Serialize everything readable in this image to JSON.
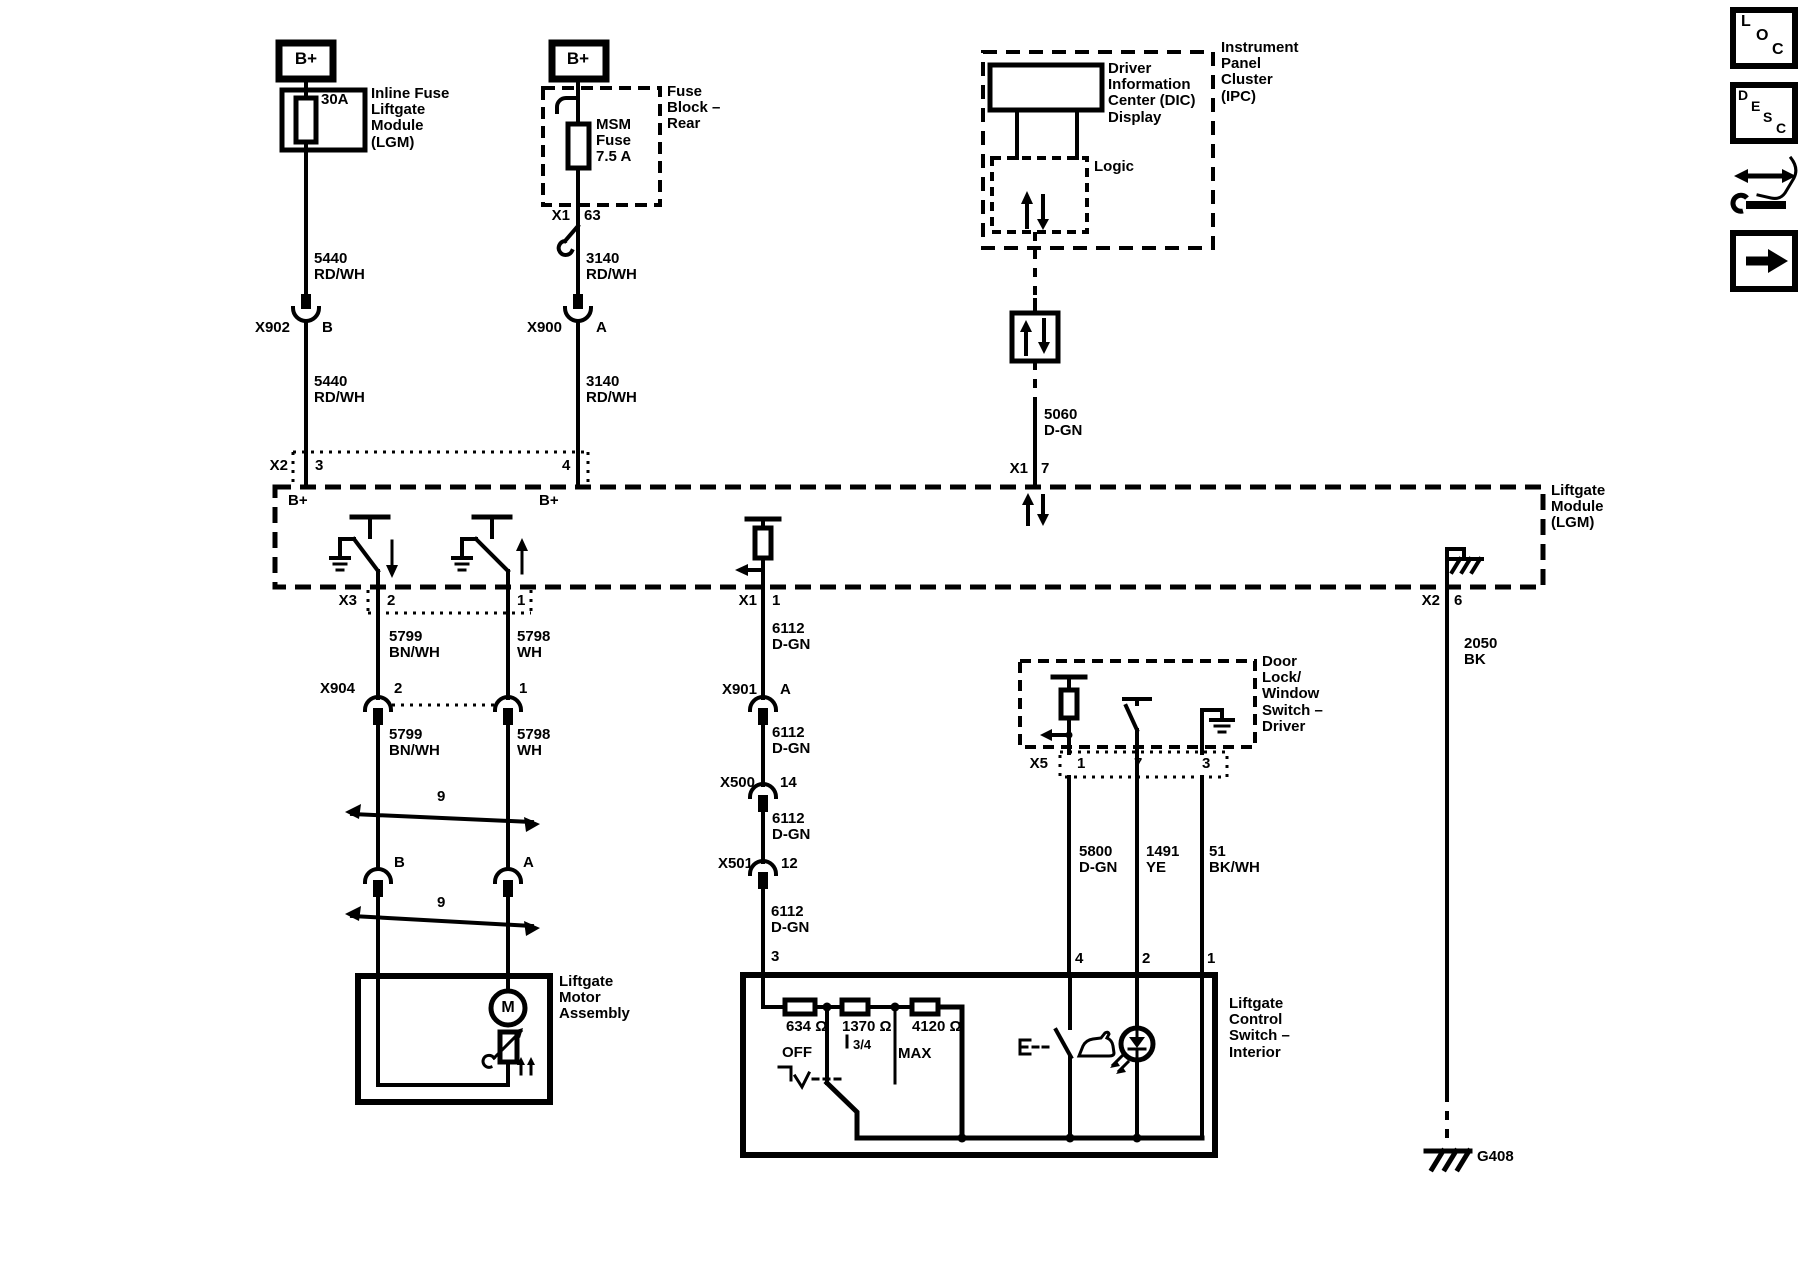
{
  "canvas": {
    "background": "#ffffff",
    "ink": "#000000",
    "kind": "wiring-diagram"
  },
  "labels": [
    {
      "name": "bplus-left-label",
      "x": 306,
      "y": 50,
      "text": "B+",
      "align": "center",
      "size": 17
    },
    {
      "name": "fuse-30a-rating",
      "x": 321,
      "y": 92,
      "text": "30A"
    },
    {
      "name": "inline-fuse-caption",
      "x": 371,
      "y": 86,
      "text": "Inline Fuse\nLiftgate\nModule\n(LGM)"
    },
    {
      "name": "wire-5440-upper",
      "x": 314,
      "y": 251,
      "text": "5440\nRD/WH"
    },
    {
      "name": "conn-x902",
      "x": 290,
      "y": 320,
      "text": "X902",
      "align": "right"
    },
    {
      "name": "conn-x902-pin-b",
      "x": 322,
      "y": 320,
      "text": "B"
    },
    {
      "name": "wire-5440-lower",
      "x": 314,
      "y": 374,
      "text": "5440\nRD/WH"
    },
    {
      "name": "conn-x2-label",
      "x": 288,
      "y": 458,
      "text": "X2",
      "align": "right"
    },
    {
      "name": "conn-x2-pin-3",
      "x": 315,
      "y": 458,
      "text": "3"
    },
    {
      "name": "conn-x2-pin-4",
      "x": 562,
      "y": 458,
      "text": "4"
    },
    {
      "name": "bplus-right-label",
      "x": 578,
      "y": 50,
      "text": "B+",
      "align": "center",
      "size": 17
    },
    {
      "name": "fuse-block-caption",
      "x": 667,
      "y": 84,
      "text": "Fuse\nBlock –\nRear"
    },
    {
      "name": "msm-fuse-caption",
      "x": 596,
      "y": 117,
      "text": "MSM\nFuse\n7.5 A"
    },
    {
      "name": "conn-x1-63",
      "x": 570,
      "y": 208,
      "text": "X1",
      "align": "right"
    },
    {
      "name": "conn-x1-pin-63",
      "x": 584,
      "y": 208,
      "text": "63"
    },
    {
      "name": "wire-3140-upper",
      "x": 586,
      "y": 251,
      "text": "3140\nRD/WH"
    },
    {
      "name": "conn-x900",
      "x": 562,
      "y": 320,
      "text": "X900",
      "align": "right"
    },
    {
      "name": "conn-x900-pin-a",
      "x": 596,
      "y": 320,
      "text": "A"
    },
    {
      "name": "wire-3140-lower",
      "x": 586,
      "y": 374,
      "text": "3140\nRD/WH"
    },
    {
      "name": "lgm-bplus-left",
      "x": 288,
      "y": 493,
      "text": "B+"
    },
    {
      "name": "lgm-bplus-right",
      "x": 539,
      "y": 493,
      "text": "B+"
    },
    {
      "name": "lgm-caption",
      "x": 1551,
      "y": 483,
      "text": "Liftgate\nModule\n(LGM)"
    },
    {
      "name": "conn-x3",
      "x": 357,
      "y": 593,
      "text": "X3",
      "align": "right"
    },
    {
      "name": "conn-x3-pin-2",
      "x": 387,
      "y": 593,
      "text": "2"
    },
    {
      "name": "conn-x3-pin-1",
      "x": 517,
      "y": 593,
      "text": "1"
    },
    {
      "name": "conn-x1-1",
      "x": 757,
      "y": 593,
      "text": "X1",
      "align": "right"
    },
    {
      "name": "conn-x1-pin-1",
      "x": 772,
      "y": 593,
      "text": "1"
    },
    {
      "name": "conn-x1-7",
      "x": 1028,
      "y": 461,
      "text": "X1",
      "align": "right"
    },
    {
      "name": "conn-x1-pin-7",
      "x": 1041,
      "y": 461,
      "text": "7"
    },
    {
      "name": "conn-x2-6",
      "x": 1440,
      "y": 593,
      "text": "X2",
      "align": "right"
    },
    {
      "name": "conn-x2-pin-6",
      "x": 1454,
      "y": 593,
      "text": "6"
    },
    {
      "name": "wire-5799-upper",
      "x": 389,
      "y": 629,
      "text": "5799\nBN/WH"
    },
    {
      "name": "wire-5798-upper",
      "x": 517,
      "y": 629,
      "text": "5798\nWH"
    },
    {
      "name": "conn-x904",
      "x": 355,
      "y": 681,
      "text": "X904",
      "align": "right"
    },
    {
      "name": "conn-x904-pin-2",
      "x": 394,
      "y": 681,
      "text": "2"
    },
    {
      "name": "conn-x904-pin-1",
      "x": 519,
      "y": 681,
      "text": "1"
    },
    {
      "name": "wire-5799-lower",
      "x": 389,
      "y": 727,
      "text": "5799\nBN/WH"
    },
    {
      "name": "wire-5798-lower",
      "x": 517,
      "y": 727,
      "text": "5798\nWH"
    },
    {
      "name": "twisted-pair-9-upper",
      "x": 437,
      "y": 789,
      "text": "9"
    },
    {
      "name": "conn-b",
      "x": 394,
      "y": 855,
      "text": "B"
    },
    {
      "name": "conn-a",
      "x": 523,
      "y": 855,
      "text": "A"
    },
    {
      "name": "twisted-pair-9-lower",
      "x": 437,
      "y": 895,
      "text": "9"
    },
    {
      "name": "motor-caption",
      "x": 559,
      "y": 974,
      "text": "Liftgate\nMotor\nAssembly"
    },
    {
      "name": "motor-m",
      "x": 508,
      "y": 999,
      "text": "M",
      "align": "center",
      "size": 16
    },
    {
      "name": "wire-6112-1",
      "x": 772,
      "y": 621,
      "text": "6112\nD-GN"
    },
    {
      "name": "conn-x901",
      "x": 757,
      "y": 682,
      "text": "X901",
      "align": "right"
    },
    {
      "name": "conn-x901-pin-a",
      "x": 780,
      "y": 682,
      "text": "A"
    },
    {
      "name": "wire-6112-2",
      "x": 772,
      "y": 725,
      "text": "6112\nD-GN"
    },
    {
      "name": "conn-x500",
      "x": 755,
      "y": 775,
      "text": "X500",
      "align": "right"
    },
    {
      "name": "conn-x500-pin-14",
      "x": 780,
      "y": 775,
      "text": "14"
    },
    {
      "name": "wire-6112-3",
      "x": 772,
      "y": 811,
      "text": "6112\nD-GN"
    },
    {
      "name": "conn-x501",
      "x": 753,
      "y": 856,
      "text": "X501",
      "align": "right"
    },
    {
      "name": "conn-x501-pin-12",
      "x": 781,
      "y": 856,
      "text": "12"
    },
    {
      "name": "wire-6112-4",
      "x": 771,
      "y": 904,
      "text": "6112\nD-GN"
    },
    {
      "name": "lcs-pin-3",
      "x": 771,
      "y": 949,
      "text": "3"
    },
    {
      "name": "resistor-634",
      "x": 786,
      "y": 1019,
      "text": "634 Ω"
    },
    {
      "name": "resistor-1370",
      "x": 842,
      "y": 1019,
      "text": "1370 Ω"
    },
    {
      "name": "resistor-4120",
      "x": 912,
      "y": 1019,
      "text": "4120 Ω"
    },
    {
      "name": "switch-pos-off",
      "x": 782,
      "y": 1045,
      "text": "OFF"
    },
    {
      "name": "switch-pos-34",
      "x": 853,
      "y": 1038,
      "text": "3/4",
      "size": 13
    },
    {
      "name": "switch-pos-max",
      "x": 898,
      "y": 1046,
      "text": "MAX"
    },
    {
      "name": "lcs-caption",
      "x": 1229,
      "y": 996,
      "text": "Liftgate\nControl\nSwitch –\nInterior"
    },
    {
      "name": "lcs-pin-4",
      "x": 1075,
      "y": 951,
      "text": "4"
    },
    {
      "name": "lcs-pin-2",
      "x": 1142,
      "y": 951,
      "text": "2"
    },
    {
      "name": "lcs-pin-1",
      "x": 1207,
      "y": 951,
      "text": "1"
    },
    {
      "name": "door-lock-caption",
      "x": 1262,
      "y": 654,
      "text": "Door\nLock/\nWindow\nSwitch –\nDriver"
    },
    {
      "name": "conn-x5",
      "x": 1048,
      "y": 756,
      "text": "X5",
      "align": "right"
    },
    {
      "name": "conn-x5-pin-1",
      "x": 1077,
      "y": 756,
      "text": "1"
    },
    {
      "name": "conn-x5-pin-7",
      "x": 1134,
      "y": 756,
      "text": "7"
    },
    {
      "name": "conn-x5-pin-3",
      "x": 1202,
      "y": 756,
      "text": "3"
    },
    {
      "name": "wire-5800",
      "x": 1079,
      "y": 844,
      "text": "5800\nD-GN"
    },
    {
      "name": "wire-1491",
      "x": 1146,
      "y": 844,
      "text": "1491\nYE"
    },
    {
      "name": "wire-51",
      "x": 1209,
      "y": 844,
      "text": "51\nBK/WH"
    },
    {
      "name": "dic-caption",
      "x": 1108,
      "y": 61,
      "text": "Driver\nInformation\nCenter (DIC)\nDisplay"
    },
    {
      "name": "ipc-caption",
      "x": 1221,
      "y": 40,
      "text": "Instrument\nPanel\nCluster\n(IPC)"
    },
    {
      "name": "logic-caption",
      "x": 1094,
      "y": 159,
      "text": "Logic"
    },
    {
      "name": "wire-5060",
      "x": 1044,
      "y": 407,
      "text": "5060\nD-GN"
    },
    {
      "name": "wire-2050",
      "x": 1464,
      "y": 636,
      "text": "2050\nBK"
    },
    {
      "name": "ground-g408",
      "x": 1477,
      "y": 1149,
      "text": "G408"
    },
    {
      "name": "loc-letter-l",
      "x": 1741,
      "y": 13,
      "text": "L",
      "size": 16
    },
    {
      "name": "loc-letter-o",
      "x": 1756,
      "y": 27,
      "text": "O",
      "size": 16
    },
    {
      "name": "loc-letter-c",
      "x": 1772,
      "y": 41,
      "text": "C",
      "size": 16
    },
    {
      "name": "desc-letter-d",
      "x": 1738,
      "y": 88,
      "text": "D",
      "size": 14
    },
    {
      "name": "desc-letter-e",
      "x": 1751,
      "y": 99,
      "text": "E",
      "size": 14
    },
    {
      "name": "desc-letter-s",
      "x": 1763,
      "y": 110,
      "text": "S",
      "size": 14
    },
    {
      "name": "desc-letter-c",
      "x": 1776,
      "y": 121,
      "text": "C",
      "size": 14
    }
  ]
}
